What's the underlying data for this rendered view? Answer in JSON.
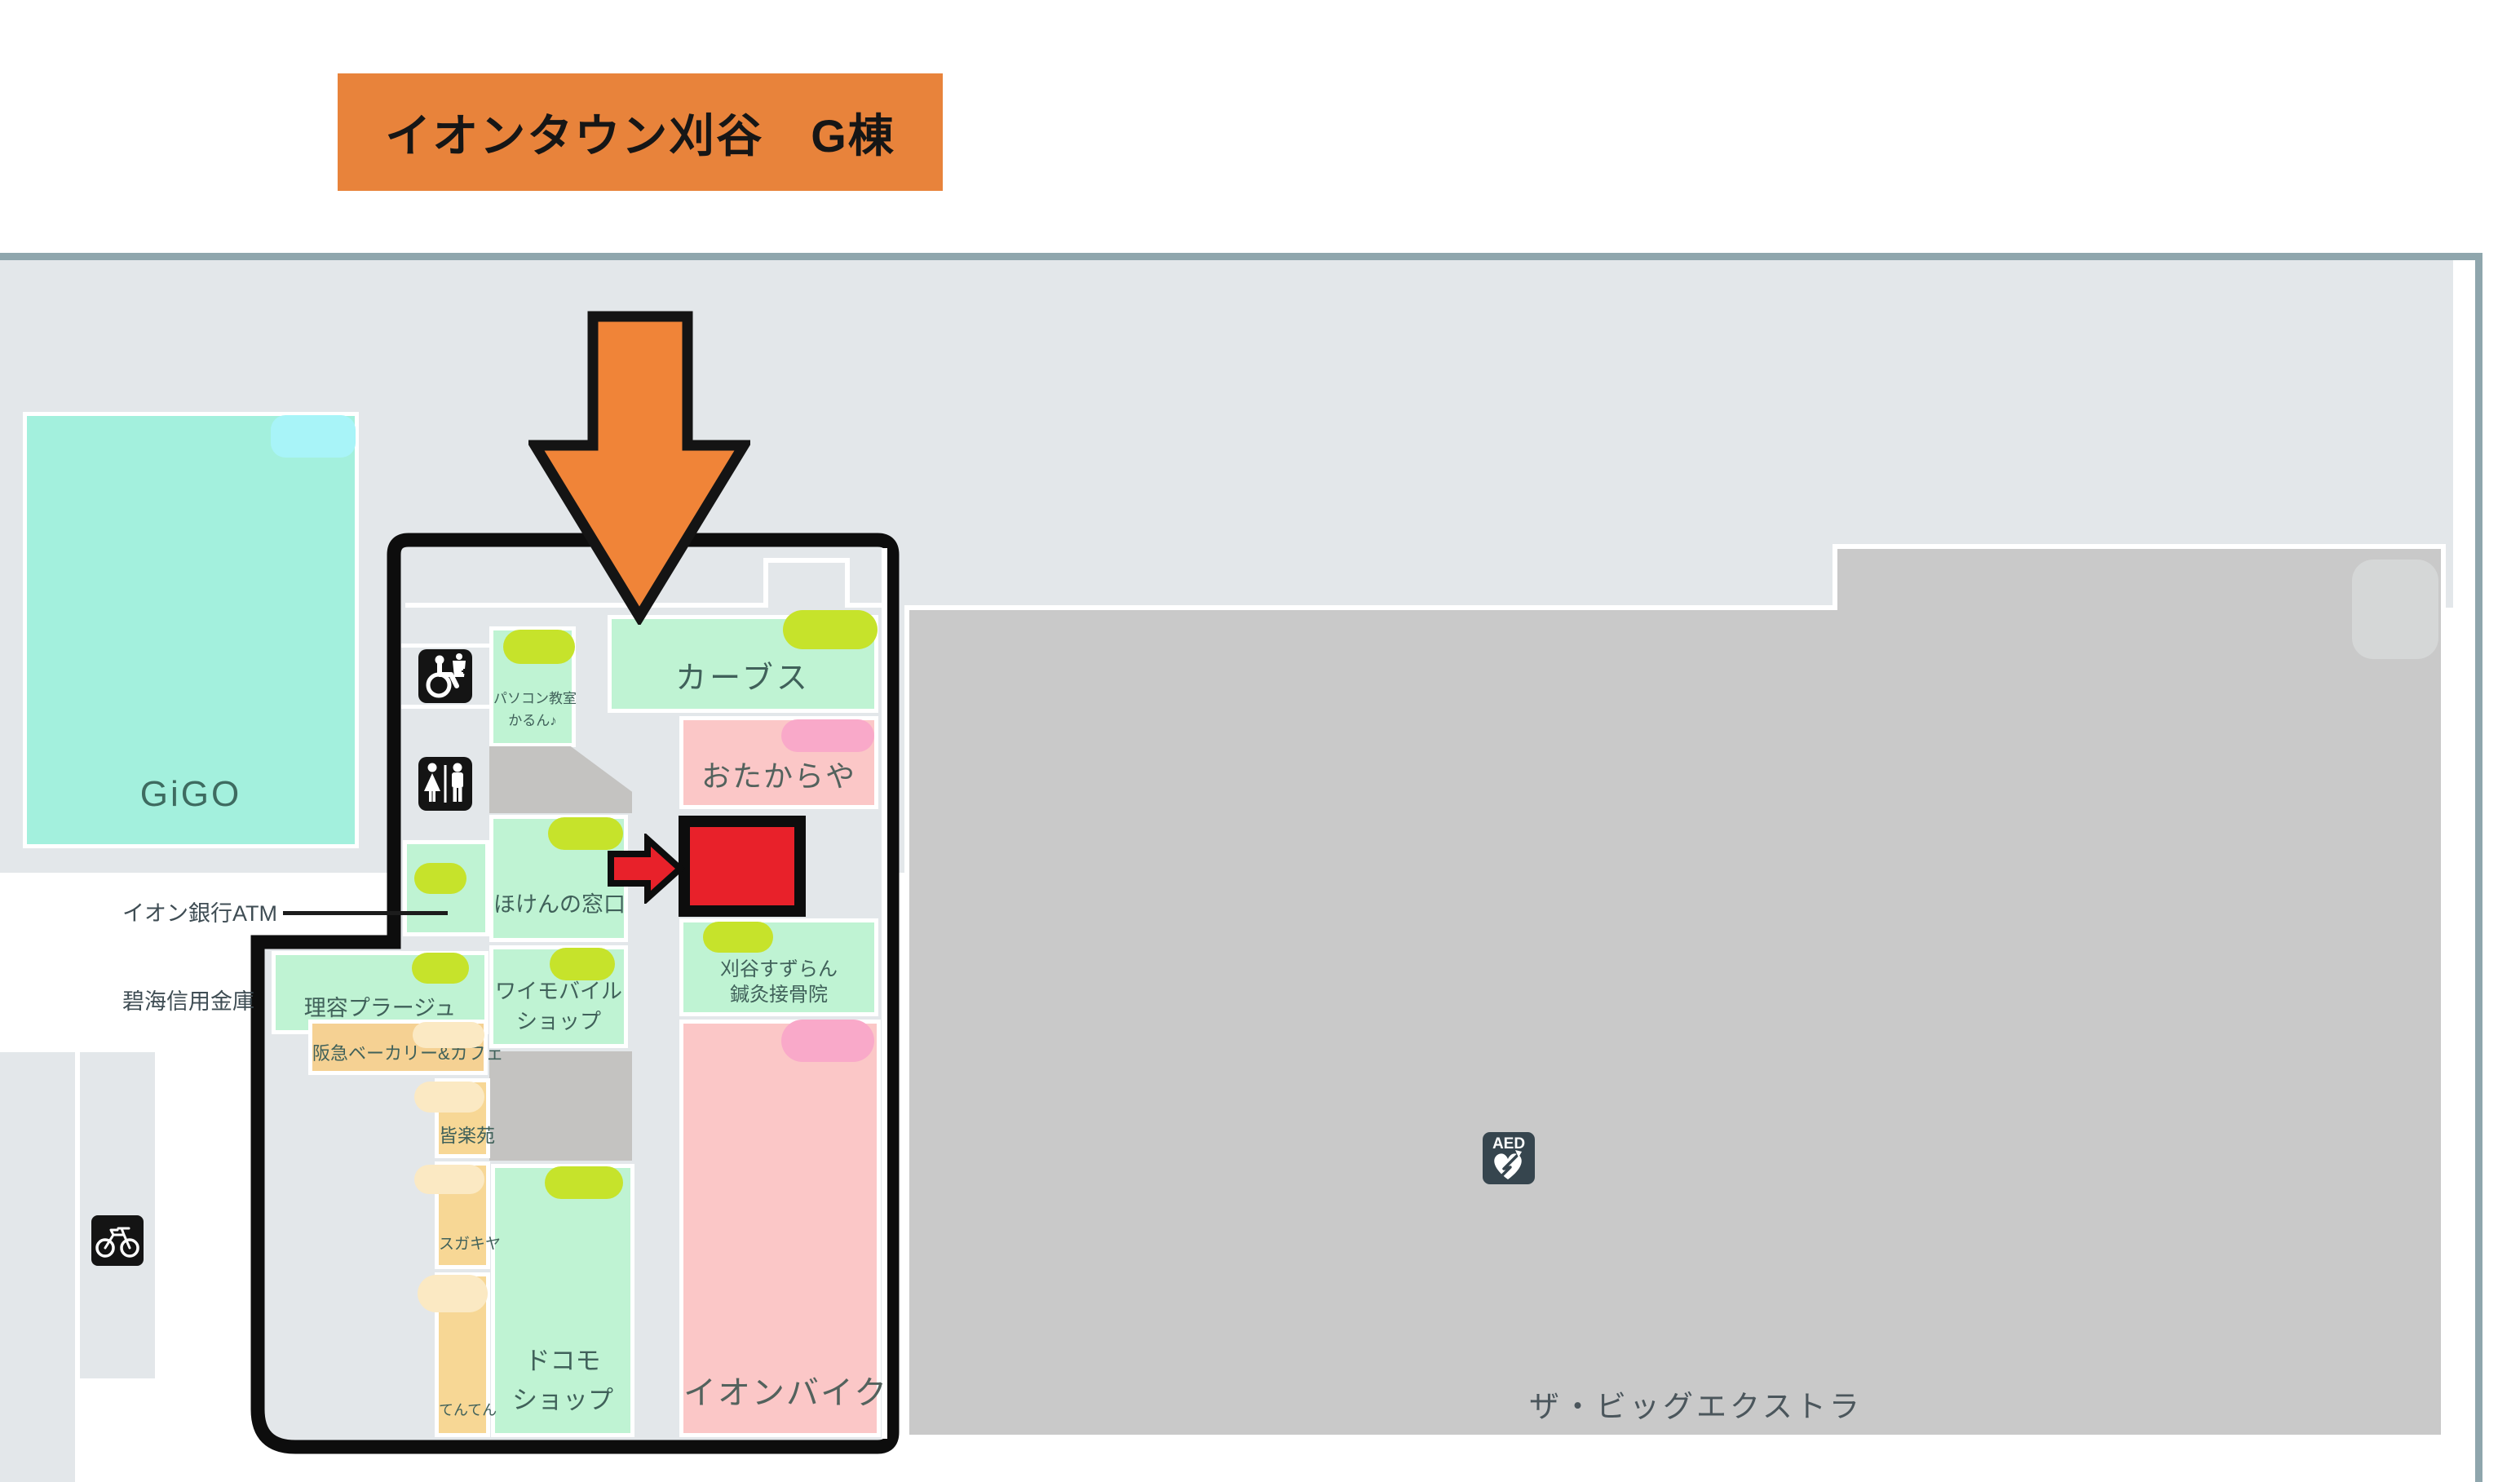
{
  "title": "イオンタウン刈谷　G棟",
  "palette": {
    "banner_orange": "#E8833B",
    "arrow_orange": "#F08438",
    "highlight_red": "#E8212A",
    "outline_black": "#0D0D0D",
    "map_bg": "#E3E7EA",
    "border_teal": "#8FA6AD",
    "big_gray": "#C9C9C9",
    "gray_tab": "#D5D7D7",
    "backyard_gray": "#C4C3C1",
    "mint": "#BFF3D3",
    "gigo_teal": "#A3F0DD",
    "cyan_tab": "#A8F4F8",
    "lime_pill": "#C6E32B",
    "pink": "#FBC7C7",
    "pink_pill": "#F9A9C9",
    "tan": "#F7D795",
    "cream_pill": "#FBE9C3",
    "label_green": "#40615A",
    "label_slate": "#3F4D54",
    "aed_slate": "#36454E"
  },
  "stores": {
    "gigo": "GiGO",
    "pasokon_lines": [
      "パソコン教室",
      "かるん♪"
    ],
    "carbs": "カーブス",
    "otakaraya": "おたからや",
    "hoken": "ほけんの窓口",
    "ymobile_lines": [
      "ワイモバイル",
      "ショップ"
    ],
    "suzuran_lines": [
      "刈谷すずらん",
      "鍼灸接骨院"
    ],
    "rihyo": "理容プラージュ",
    "hankyu": "阪急ベーカリー&カフェ",
    "minrakuen": "皆楽苑",
    "sugakiya": "スガキヤ",
    "tenten": "てんてん",
    "docomo_lines": [
      "ドコモ",
      "ショップ"
    ],
    "ionbike": "イオンバイク",
    "bigextra": "ザ・ビッグエクストラ"
  },
  "labels": {
    "atm": "イオン銀行ATM",
    "shinkin": "碧海信用金庫"
  },
  "icons": {
    "aed_label": "AED",
    "accessible": "accessible-restroom-icon",
    "restroom": "restroom-icon",
    "bicycle": "bicycle-parking-icon",
    "aed": "aed-icon"
  }
}
